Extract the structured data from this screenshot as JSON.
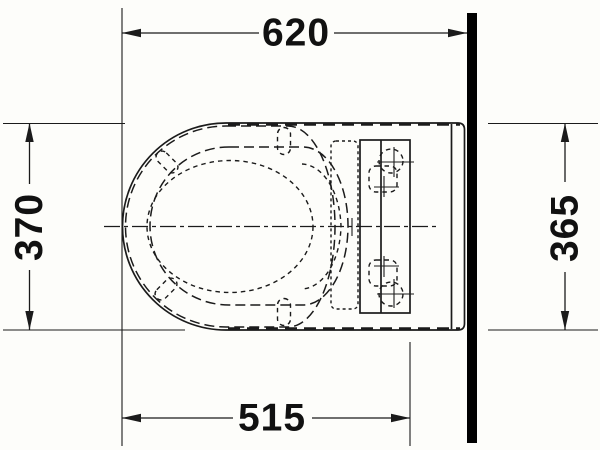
{
  "page": {
    "background": "#fdfdfa"
  },
  "colors": {
    "line": "#1b1b1b",
    "wall": "#000000",
    "background": "#fdfdfa",
    "dim_text": "#111111"
  },
  "drawing": {
    "dimensions": {
      "top_width": {
        "value": "620"
      },
      "left_depth": {
        "value": "370"
      },
      "right_depth": {
        "value": "365"
      },
      "bottom_width": {
        "value": "515"
      }
    }
  }
}
